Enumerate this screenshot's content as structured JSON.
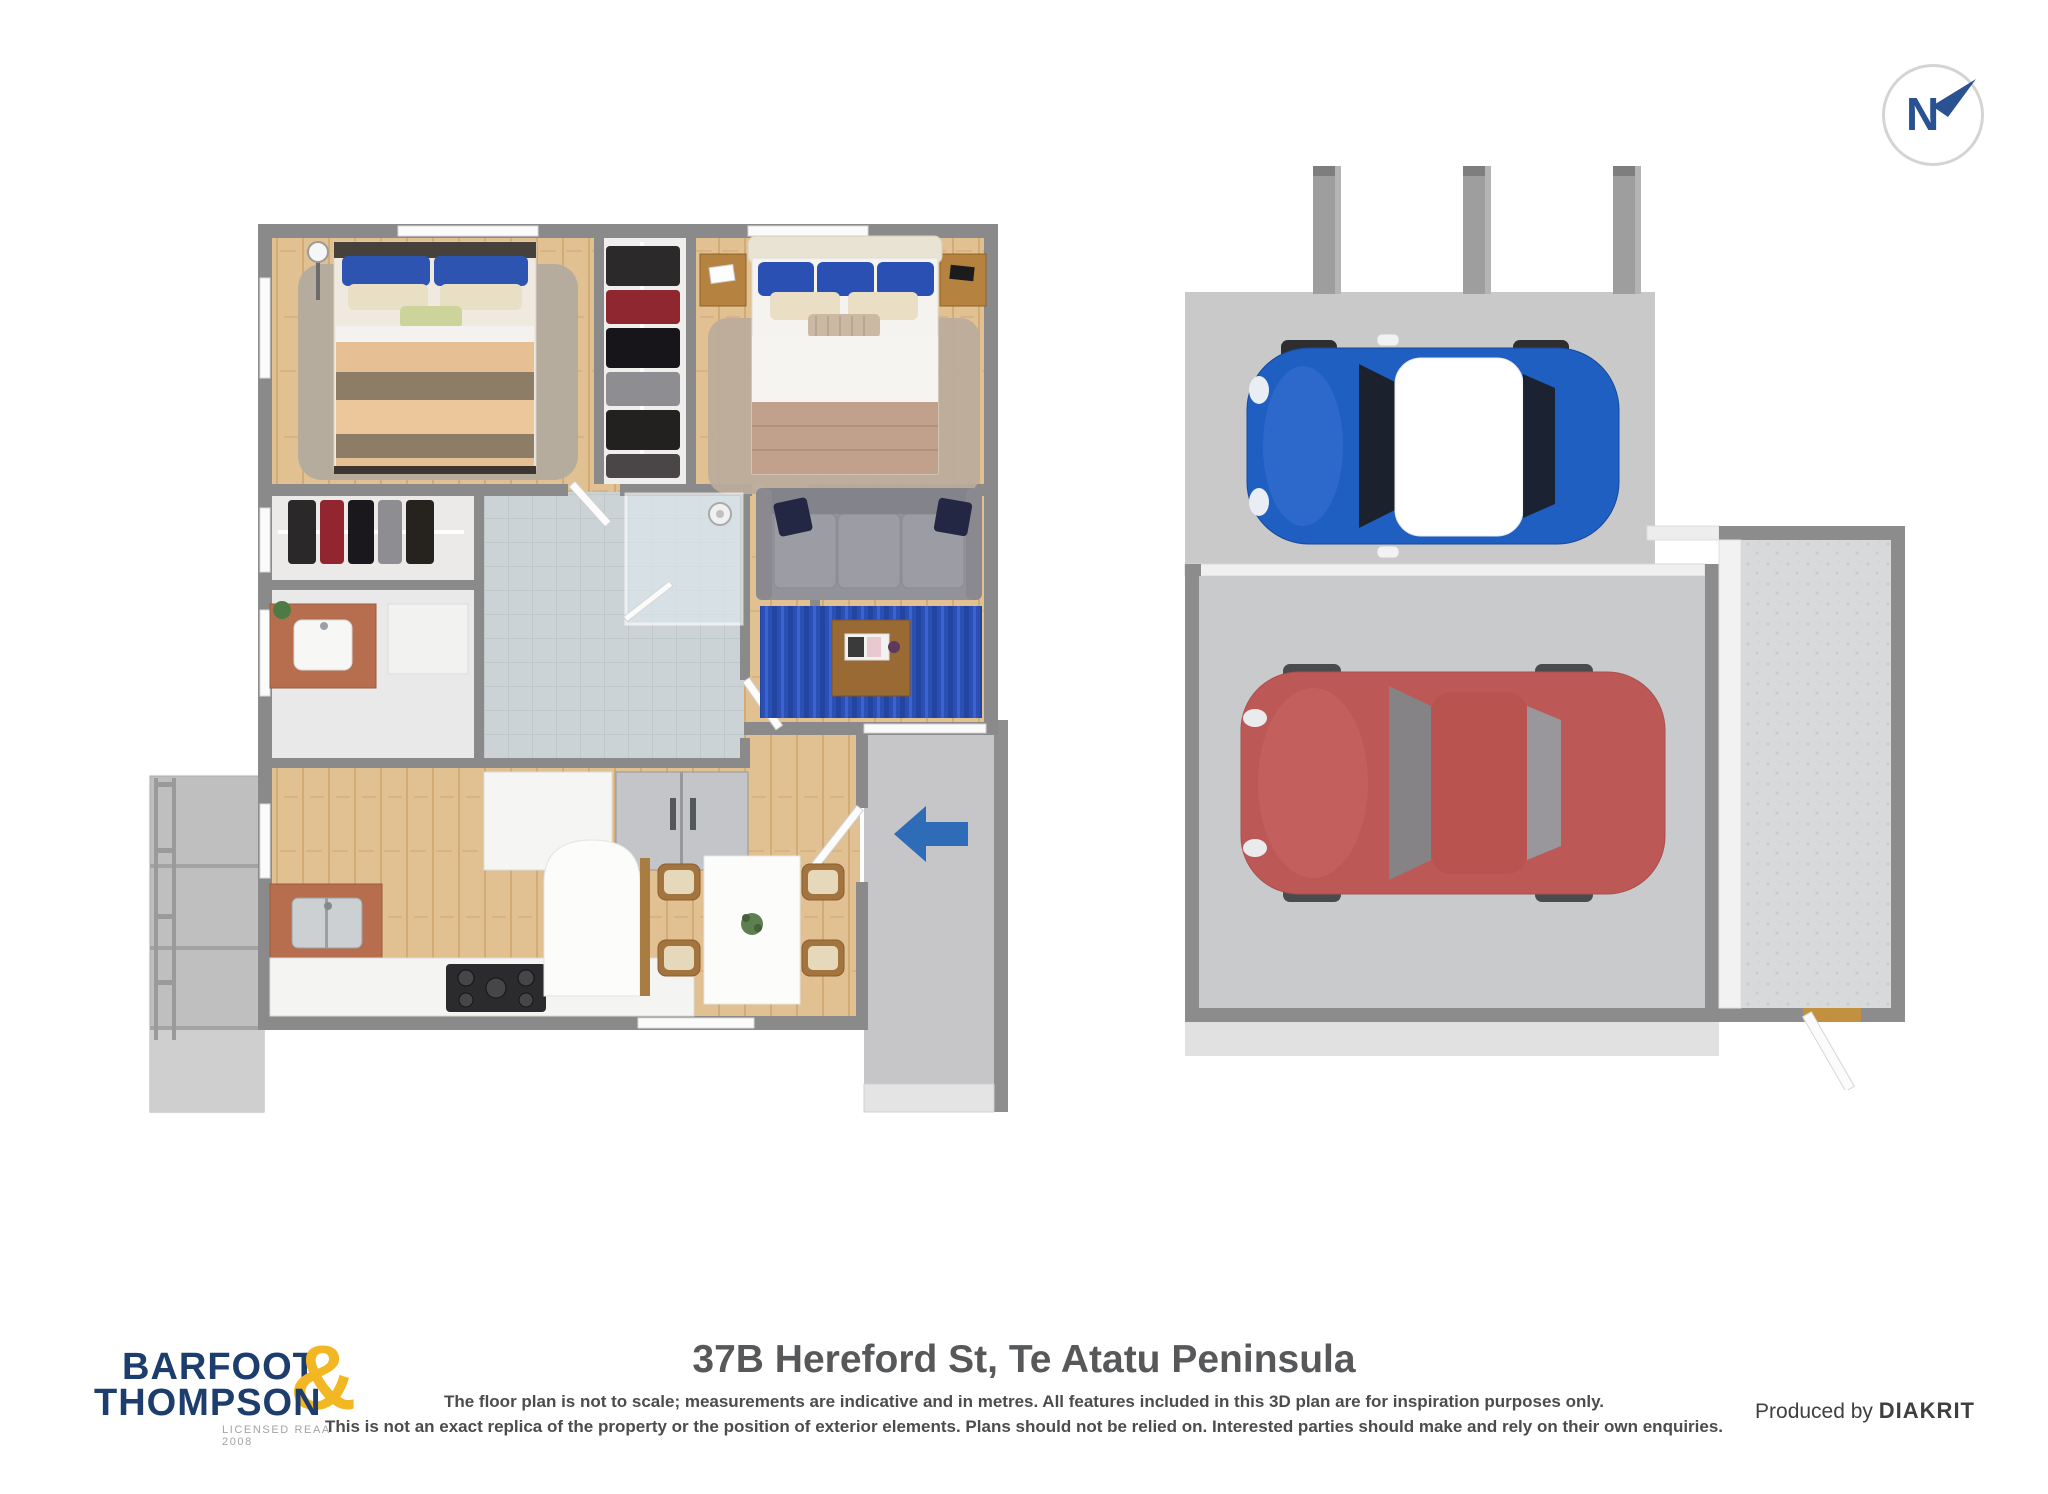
{
  "compass": {
    "label": "N"
  },
  "branding": {
    "name_top": "BARFOOT",
    "ampersand": "&",
    "name_bottom": "THOMPSON",
    "license": "LICENSED REAA 2008"
  },
  "footer": {
    "address": "37B Hereford St, Te Atatu Peninsula",
    "disclaimer_line1": "The floor plan is not to scale; measurements are indicative and in metres. All features included in this 3D plan are for inspiration purposes only.",
    "disclaimer_line2": "This is not an exact replica of the property or the position of exterior elements. Plans should not be relied on. Interested parties should make and rely on their own enquiries.",
    "produced_by": "Produced by",
    "producer": "DIAKRIT"
  },
  "colors": {
    "brand_navy": "#1d3d6d",
    "brand_yellow": "#f2b722",
    "compass_blue": "#2a5191",
    "entry_arrow_blue": "#2e6cb8",
    "rug_blue": "#2b50b5",
    "mini_car_blue": "#1f5fc2",
    "garage_car_red": "#bb4a47",
    "wood_floor": "#e1c092",
    "wall_gray": "#8a8a8a",
    "carport_slab": "#c9c9c9"
  }
}
